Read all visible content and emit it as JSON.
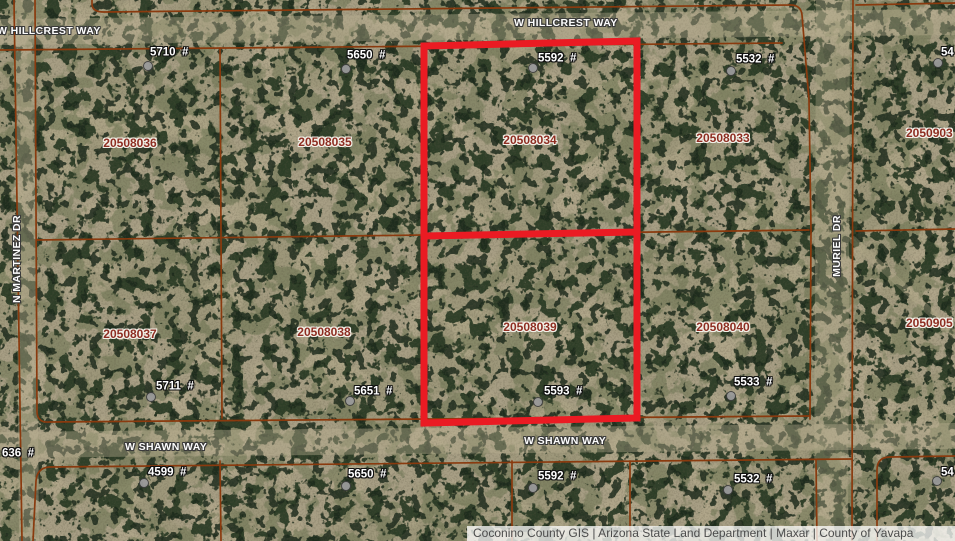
{
  "map": {
    "attribution": "Coconino County GIS | Arizona State Land Department | Maxar | County of Yavapa",
    "highlighted_parcels": [
      "20508034",
      "20508039"
    ],
    "colors": {
      "highlight_red": "#ea1b23",
      "parcel_line": "#8a3a0e",
      "parcel_label_text": "#8e2e22",
      "street_label_text": "#fdfdfd",
      "address_label_text": "#ffffff",
      "attribution_bg": "rgba(255,255,255,0.75)",
      "attribution_text": "#4c4c4c"
    }
  },
  "streets": [
    "W HILLCREST WAY",
    "W HILLCREST WAY",
    "N MARTINEZ DR",
    "MURIEL DR",
    "W SHAWN WAY",
    "W SHAWN WAY"
  ],
  "parcels": [
    "20508036",
    "20508035",
    "20508034",
    "20508033",
    "2050903",
    "20508037",
    "20508038",
    "20508039",
    "20508040",
    "2050905"
  ],
  "addresses": [
    "5710  #",
    "5650  #",
    "5592  #",
    "5532  #",
    "54",
    "5711  #",
    "5651  #",
    "5593  #",
    "5533  #",
    "636  #",
    "4599  #",
    "5650  #",
    "5592  #",
    "5532  #",
    "54"
  ]
}
